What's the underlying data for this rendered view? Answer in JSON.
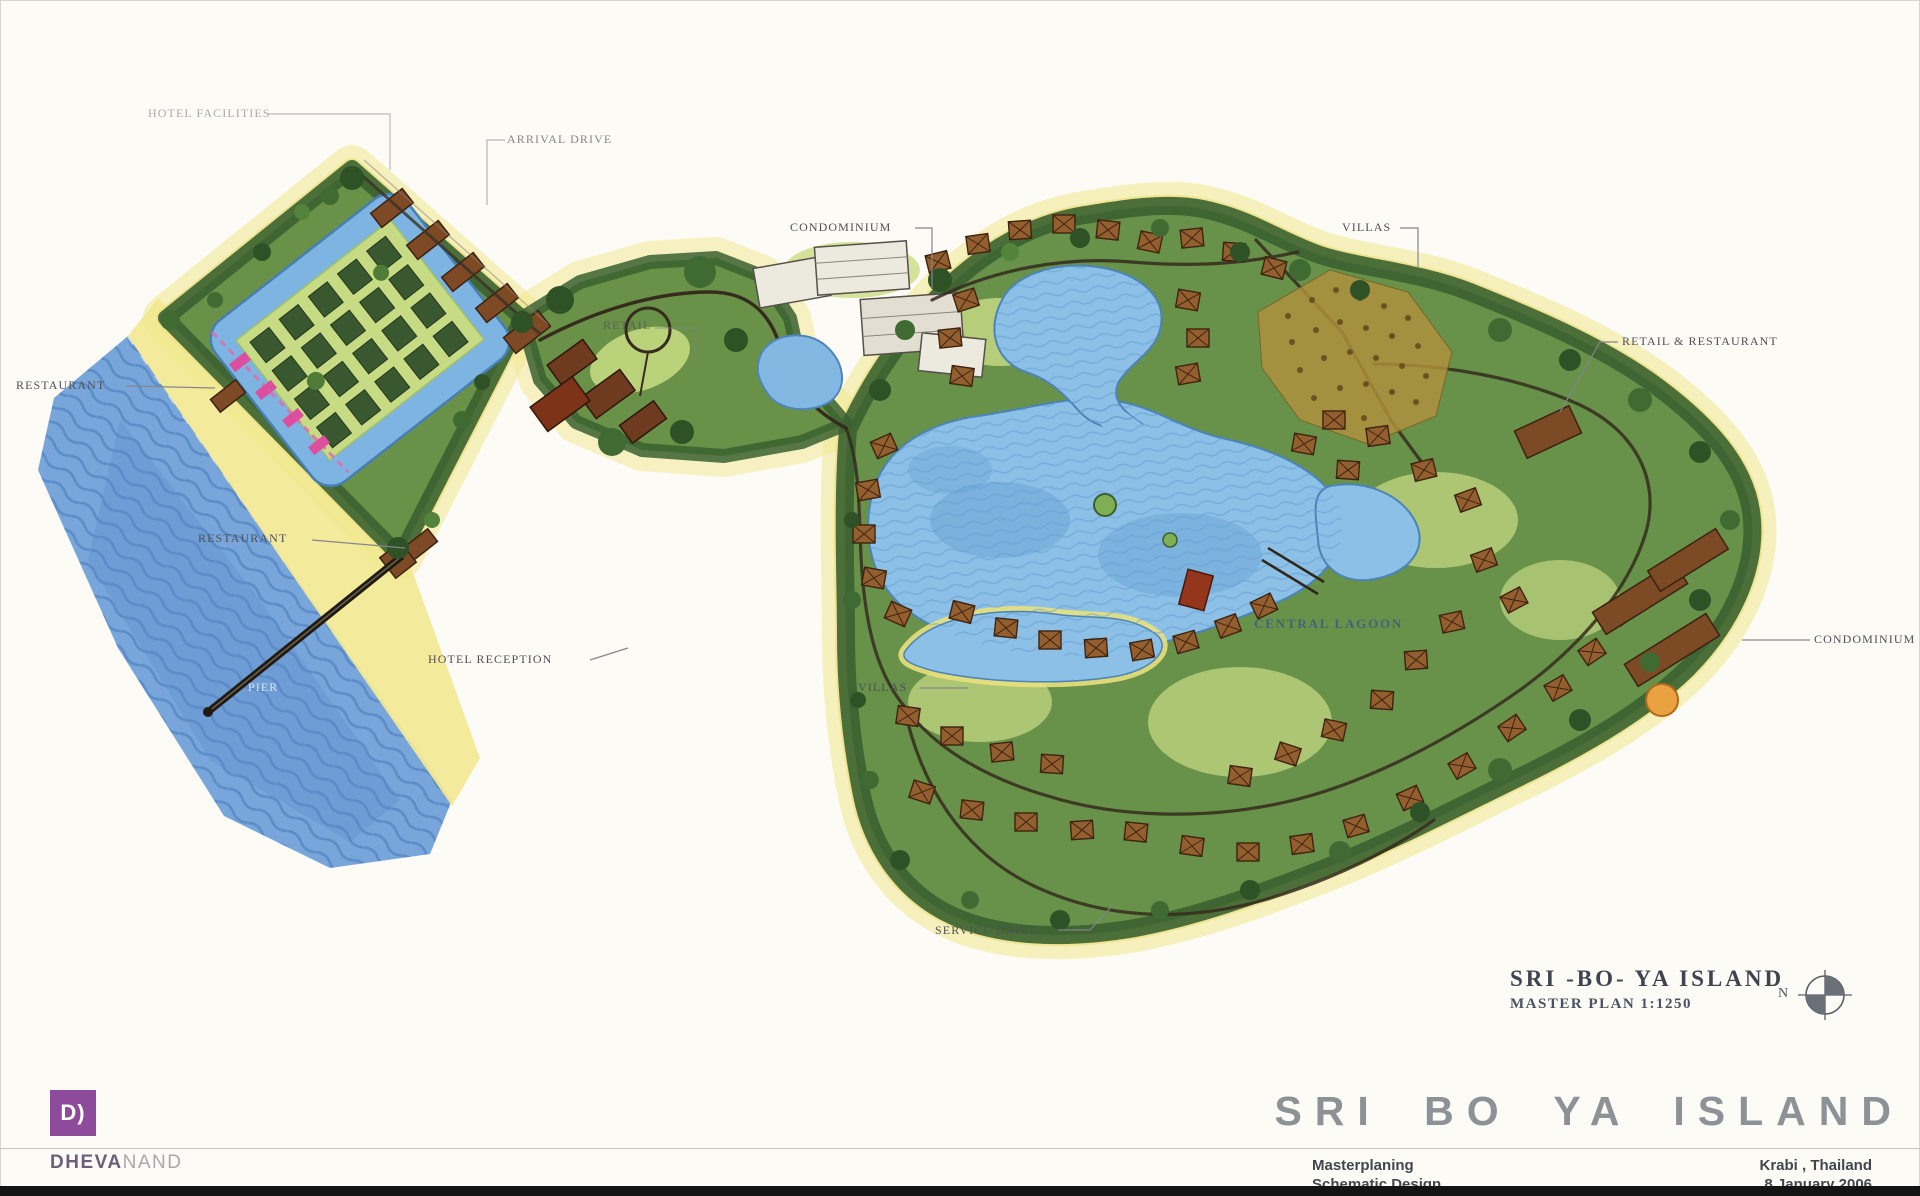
{
  "plan": {
    "labels": {
      "hotel_facilities": "HOTEL FACILITIES",
      "arrival_drive": "ARRIVAL DRIVE",
      "retail": "RETAIL",
      "condominium_top": "CONDOMINIUM",
      "villas_top": "VILLAS",
      "retail_restaurant": "RETAIL & RESTAURANT",
      "restaurant_beach": "RESTAURANT",
      "restaurant_mid": "RESTAURANT",
      "hotel_reception": "HOTEL RECEPTION",
      "pier": "PIER",
      "central_lagoon": "CENTRAL LAGOON",
      "villas_west": "VILLAS",
      "service_drive": "SERVICE DRIVE",
      "condominium_east": "CONDOMINIUM"
    },
    "title_block": {
      "line1": "SRI -BO- YA ISLAND",
      "line2": "MASTER PLAN 1:1250",
      "north_label": "N"
    }
  },
  "footer": {
    "project_title": "SRI BO YA ISLAND",
    "logo_mark": "D)",
    "logo_name_primary": "DHEVA",
    "logo_name_secondary": "NAND",
    "discipline_line1": "Masterplaning",
    "discipline_line2": "Schematic  Design",
    "location_line1": "Krabi , Thailand",
    "date_line1": "8 January 2006"
  },
  "colors": {
    "sea": "#78a6da",
    "sand": "#f2e892",
    "lagoon": "#8cc0e6",
    "vegetation": "#68914a",
    "canopy": "#3a6030",
    "villa_roof": "#935f2e",
    "accent_pink": "#dd4f9e",
    "accent_purple": "#8e4a9b",
    "label_ink": "#4f4f58"
  }
}
